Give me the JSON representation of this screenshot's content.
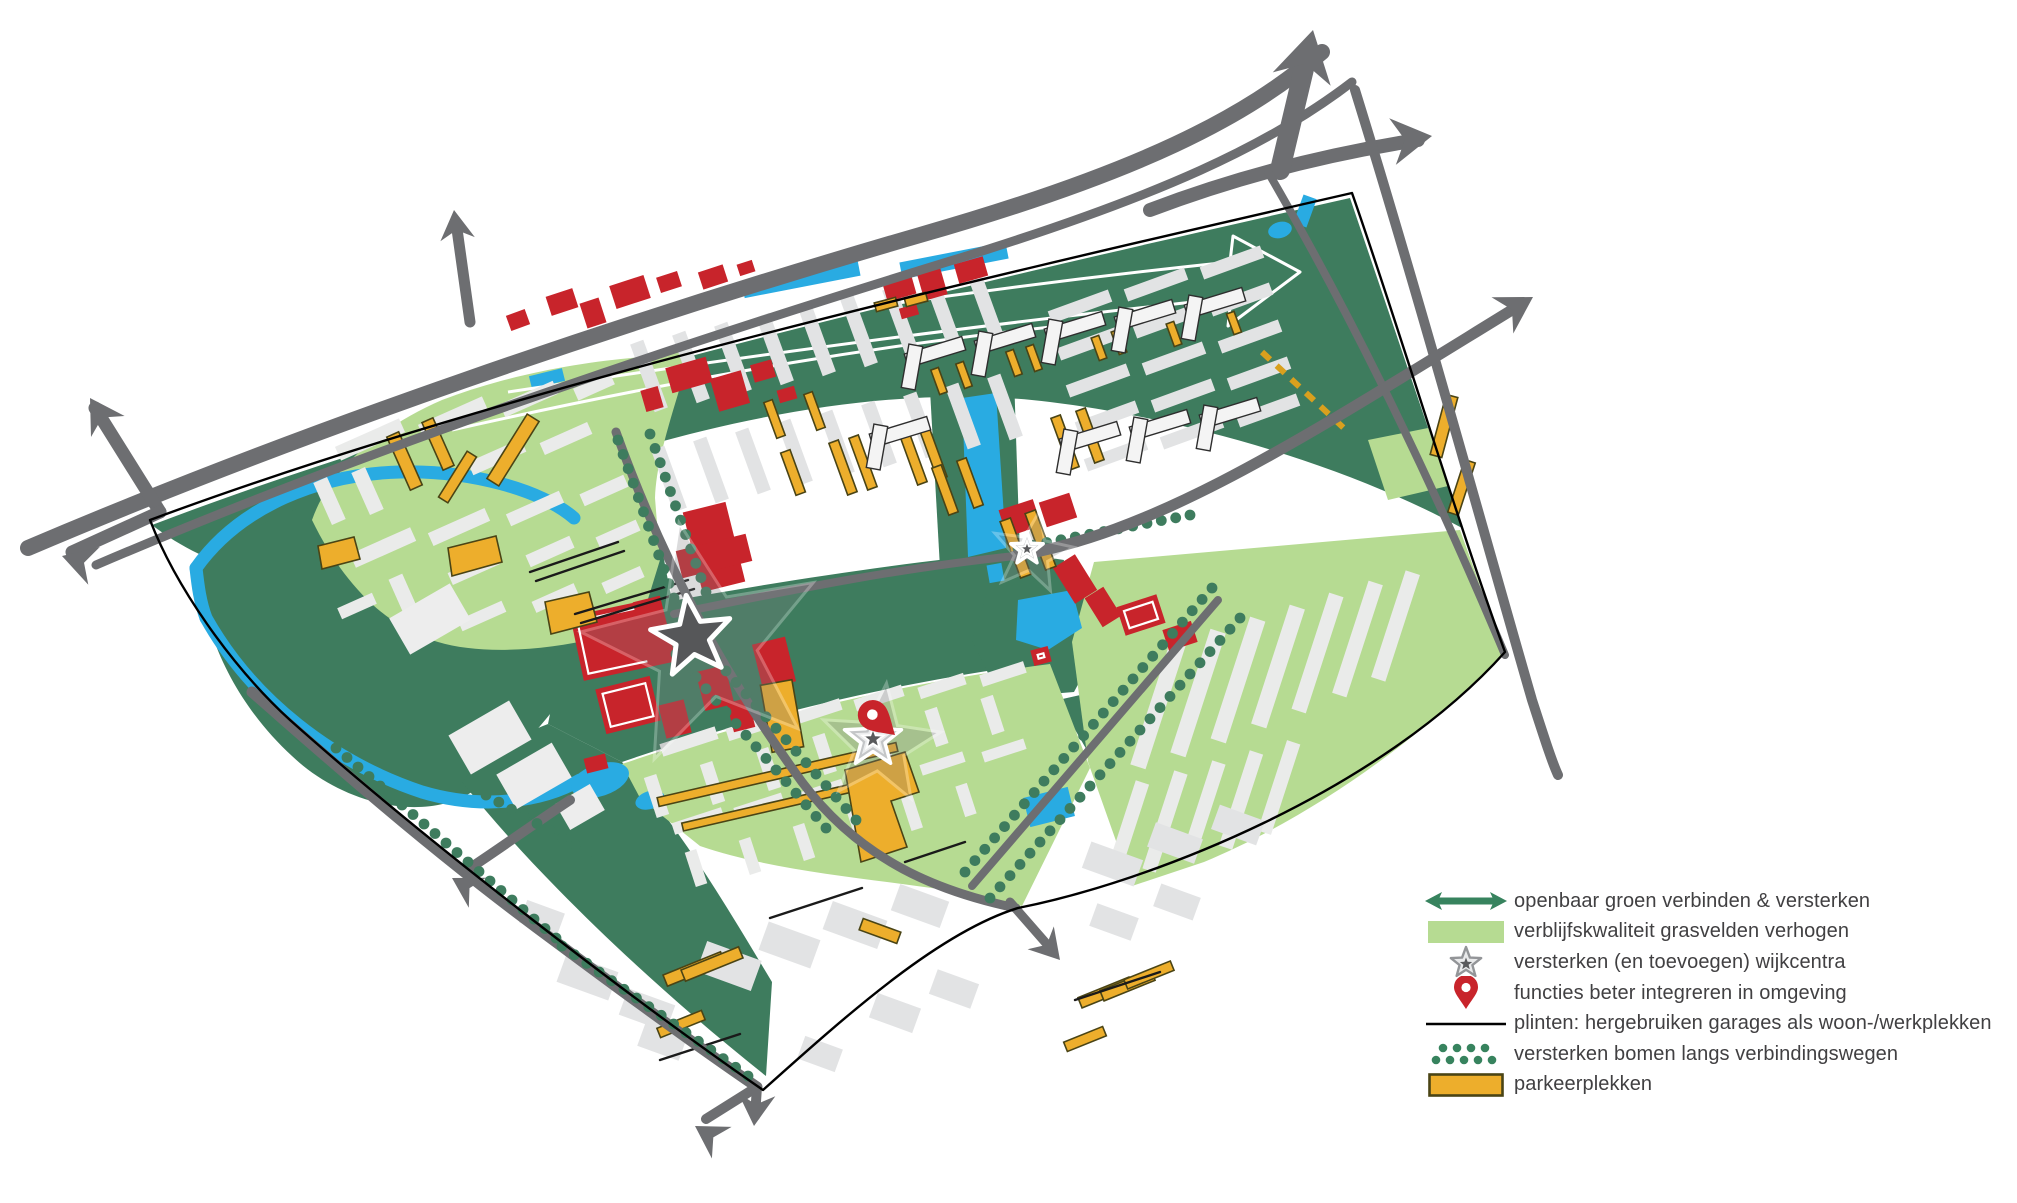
{
  "figure": {
    "kind": "urban-plan-map"
  },
  "palette": {
    "dark_green": "#3E7C5E",
    "light_green": "#B6DB92",
    "legend_green": "#37835E",
    "water_blue": "#29ABE2",
    "road_gray": "#6D6E71",
    "building_red": "#C8242B",
    "parking_yellow": "#EDAE2C",
    "parking_outline": "#4A4415",
    "star_gray": "#58595B",
    "text": "#414042",
    "background": "#FFFFFF"
  },
  "legend": {
    "items": [
      {
        "icon": "double-arrow-icon",
        "label": "openbaar groen verbinden & versterken"
      },
      {
        "icon": "grass-swatch-icon",
        "label": "verblijfskwaliteit grasvelden verhogen"
      },
      {
        "icon": "wijkcentra-star-icon",
        "label": "versterken (en toevoegen) wijkcentra"
      },
      {
        "icon": "red-pin-icon",
        "label": "functies beter integreren in omgeving"
      },
      {
        "icon": "plint-line-icon",
        "label": "plinten: hergebruiken garages als woon-/werkplekken"
      },
      {
        "icon": "tree-dots-icon",
        "label": "versterken bomen langs verbindingswegen"
      },
      {
        "icon": "parking-swatch-icon",
        "label": "parkeerplekken"
      }
    ]
  }
}
